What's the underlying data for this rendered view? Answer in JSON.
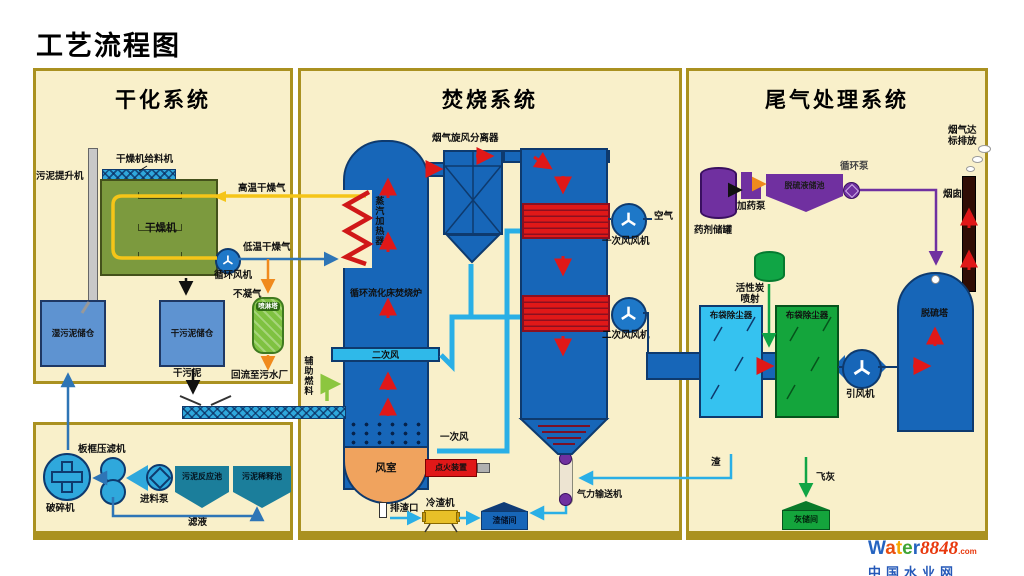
{
  "title": "工艺流程图",
  "sections": {
    "drying": "干化系统",
    "incineration": "焚烧系统",
    "tailgas": "尾气处理系统"
  },
  "drying": {
    "sludge_elevator": "污泥提升机",
    "dryer_feeder": "干燥机给料机",
    "dryer": "干燥机",
    "hot_dry_gas": "高温干燥气",
    "low_dry_gas": "低温干燥气",
    "circulation_fan": "循环风机",
    "noncondensable_gas": "不凝气",
    "spray_tower": "喷淋塔",
    "return_to_plant": "回流至污水厂",
    "wet_sludge_silo": "湿污泥储仓",
    "dry_sludge_silo": "干污泥储仓",
    "dry_sludge": "干污泥",
    "crusher": "破碎机",
    "filter_press": "板框压滤机",
    "feed_pump": "进料泵",
    "reaction_tank": "污泥反应池",
    "dilution_tank": "污泥稀释池",
    "filtrate": "滤液"
  },
  "incineration": {
    "cyclone": "烟气旋风分离器",
    "steam_heater": "蒸汽加热器",
    "furnace": "循环流化床焚烧炉",
    "secondary_air": "二次风",
    "primary_air": "一次风",
    "aux_fuel": "辅助燃料",
    "wind_box": "风室",
    "igniter": "点火装置",
    "slag_port": "排渣口",
    "slag_cooler": "冷渣机",
    "slag_room": "渣储间",
    "pneumatic_conveyor": "气力输送机",
    "air": "空气",
    "primary_fan": "一次风风机",
    "secondary_fan": "二次风风机"
  },
  "tailgas": {
    "chemical_tank": "药剂储罐",
    "dosing_pump": "加药泵",
    "desulf_tank": "脱硫液储池",
    "circulation_pump": "循环泵",
    "carbon_injection_1": "活性炭",
    "carbon_injection_2": "喷射",
    "bag_filter_1": "布袋除尘器",
    "bag_filter_2": "布袋除尘器",
    "id_fan": "引风机",
    "slag": "渣",
    "fly_ash": "飞灰",
    "ash_room": "灰储间",
    "desulf_tower": "脱硫塔",
    "emission_line1": "烟气达",
    "emission_line2": "标排放",
    "chimney": "烟囱"
  },
  "logo": {
    "letters": [
      "W",
      "a",
      "t",
      "e",
      "r"
    ],
    "number": "8848",
    "dotcom": ".com",
    "cn": "中国水业网"
  },
  "colors": {
    "panel_bg": "#F9F0CA",
    "panel_border": "#AA9120",
    "main_blue": "#1766B8",
    "cyan_pipe": "#2AAFE6",
    "red": "#E01818",
    "windbox_orange": "#F0A35E",
    "purple": "#7030A0",
    "green": "#14A53C",
    "dryer_green": "#7C9A3E",
    "yellow": "#F5C518"
  }
}
